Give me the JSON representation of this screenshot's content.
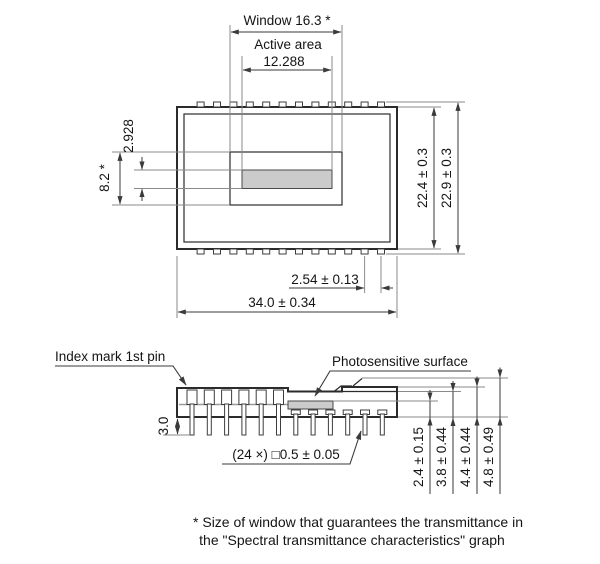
{
  "top_view": {
    "window_width_label": "Window 16.3 *",
    "active_area_label": "Active area",
    "active_area_width": "12.288",
    "active_area_height": "2.928",
    "window_height": "8.2 *",
    "package_height": "22.4 ± 0.3",
    "overall_height": "22.9 ± 0.3",
    "pin_pitch": "2.54 ± 0.13",
    "package_width": "34.0 ± 0.34"
  },
  "side_view": {
    "index_mark_label": "Index mark 1st pin",
    "photosensitive_surface_label": "Photosensitive surface",
    "pin_length": "3.0",
    "pin_cross_section": "(24 ×) □0.5 ± 0.05",
    "dim_surface": "2.4 ± 0.15",
    "dim_window": "3.8 ± 0.44",
    "dim_body": "4.4 ± 0.44",
    "dim_overall": "4.8 ± 0.49"
  },
  "footnote": {
    "line1": "* Size of window that guarantees the transmittance in",
    "line2": "the \"Spectral transmittance characteristics\" graph"
  },
  "colors": {
    "outline": "#2b2b2b",
    "dimension_line": "#3a3a3a",
    "extension_line": "#8a8a8a",
    "photosensitive_fill": "#cbcbcb",
    "background": "#ffffff"
  }
}
